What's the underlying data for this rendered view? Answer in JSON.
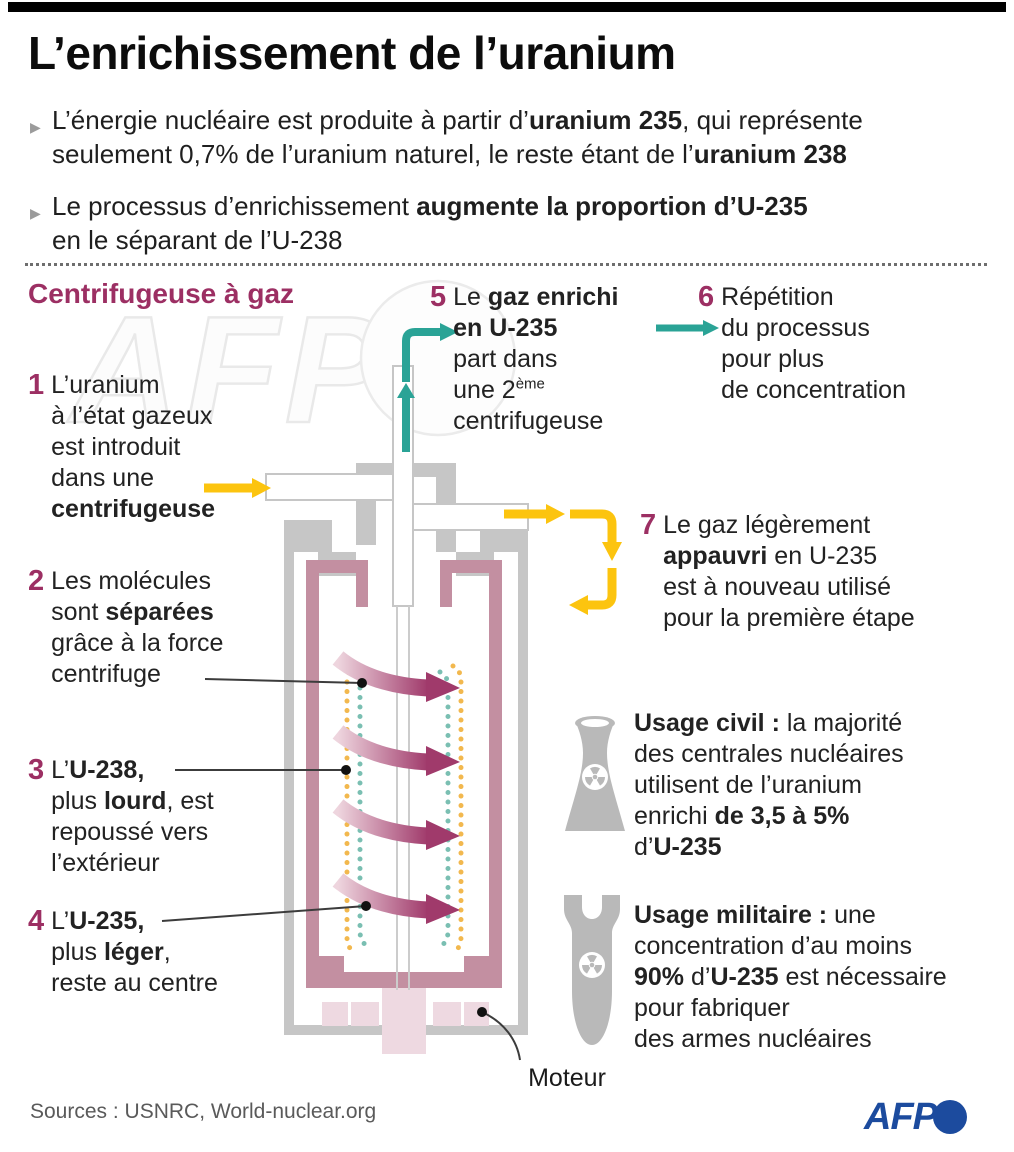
{
  "colors": {
    "accent_magenta": "#9c2f63",
    "teal_arrow": "#2aa396",
    "yellow_arrow": "#fcc40f",
    "rotor_pink": "#c38fa1",
    "motor_pink": "#eed9e1",
    "casing_gray": "#c6c6c6",
    "afp_blue": "#1c4b9e"
  },
  "header": {
    "title": "L’enrichissement de l’uranium"
  },
  "intro": {
    "bullet1": {
      "line1_pre": "L’énergie nucléaire est produite à partir d’",
      "line1_bold": "uranium 235",
      "line1_post": ", qui représente",
      "line2_pre": "seulement 0,7% de l’uranium naturel, le reste étant de l’",
      "line2_bold": "uranium 238"
    },
    "bullet2": {
      "line1_pre": "Le processus d’enrichissement ",
      "line1_bold": "augmente la proportion d’U-235",
      "line2": "en le séparant de l’U-238"
    }
  },
  "diagram": {
    "section_label": "Centrifugeuse à gaz",
    "motor_label": "Moteur",
    "steps": {
      "s1": {
        "num": "1",
        "l1": "L’uranium",
        "l2": "à l’état gazeux",
        "l3": "est introduit",
        "l4": "dans une",
        "l5": "centrifugeuse"
      },
      "s2": {
        "num": "2",
        "l1": "Les molécules",
        "l2a": "sont ",
        "l2b": "séparées",
        "l3": "grâce à la force",
        "l4": "centrifuge"
      },
      "s3": {
        "num": "3",
        "l1a": "L’",
        "l1b": "U-238,",
        "l2a": "plus ",
        "l2b": "lourd",
        "l2c": ", est",
        "l3": "repoussé vers",
        "l4": "l’extérieur"
      },
      "s4": {
        "num": "4",
        "l1a": "L’",
        "l1b": "U-235,",
        "l2a": "plus ",
        "l2b": "léger",
        "l2c": ",",
        "l3": "reste au centre"
      },
      "s5": {
        "num": "5",
        "l1a": "Le ",
        "l1b": "gaz enrichi",
        "l2": "en U-235",
        "l3": "part dans",
        "l4a": "une 2",
        "l4sup": "ème",
        "l5": "centrifugeuse"
      },
      "s6": {
        "num": "6",
        "l1": "Répétition",
        "l2": "du processus",
        "l3": "pour plus",
        "l4": "de concentration"
      },
      "s7": {
        "num": "7",
        "l1": "Le gaz légèrement",
        "l2a": "appauvri",
        "l2b": " en U-235",
        "l3": "est à nouveau utilisé",
        "l4": "pour la première étape"
      }
    }
  },
  "usages": {
    "civil": {
      "icon": "cooling-tower-icon",
      "l1b": "Usage civil :",
      "l1r": " la majorité",
      "l2": "des centrales nucléaires",
      "l3": "utilisent de l’uranium",
      "l4a": "enrichi ",
      "l4b": "de 3,5 à 5%",
      "l5a": "d’",
      "l5b": "U-235"
    },
    "military": {
      "icon": "bomb-icon",
      "l1b": "Usage militaire :",
      "l1r": " une",
      "l2": "concentration d’au moins",
      "l3a": "90%",
      "l3b": " d’",
      "l3c": "U-235",
      "l3d": " est nécessaire",
      "l4": "pour fabriquer",
      "l5": "des armes nucléaires"
    }
  },
  "watermark": {
    "text": "AFP"
  },
  "footer": {
    "sources": "Sources : USNRC, World-nuclear.org",
    "logo_text": "AFP"
  }
}
